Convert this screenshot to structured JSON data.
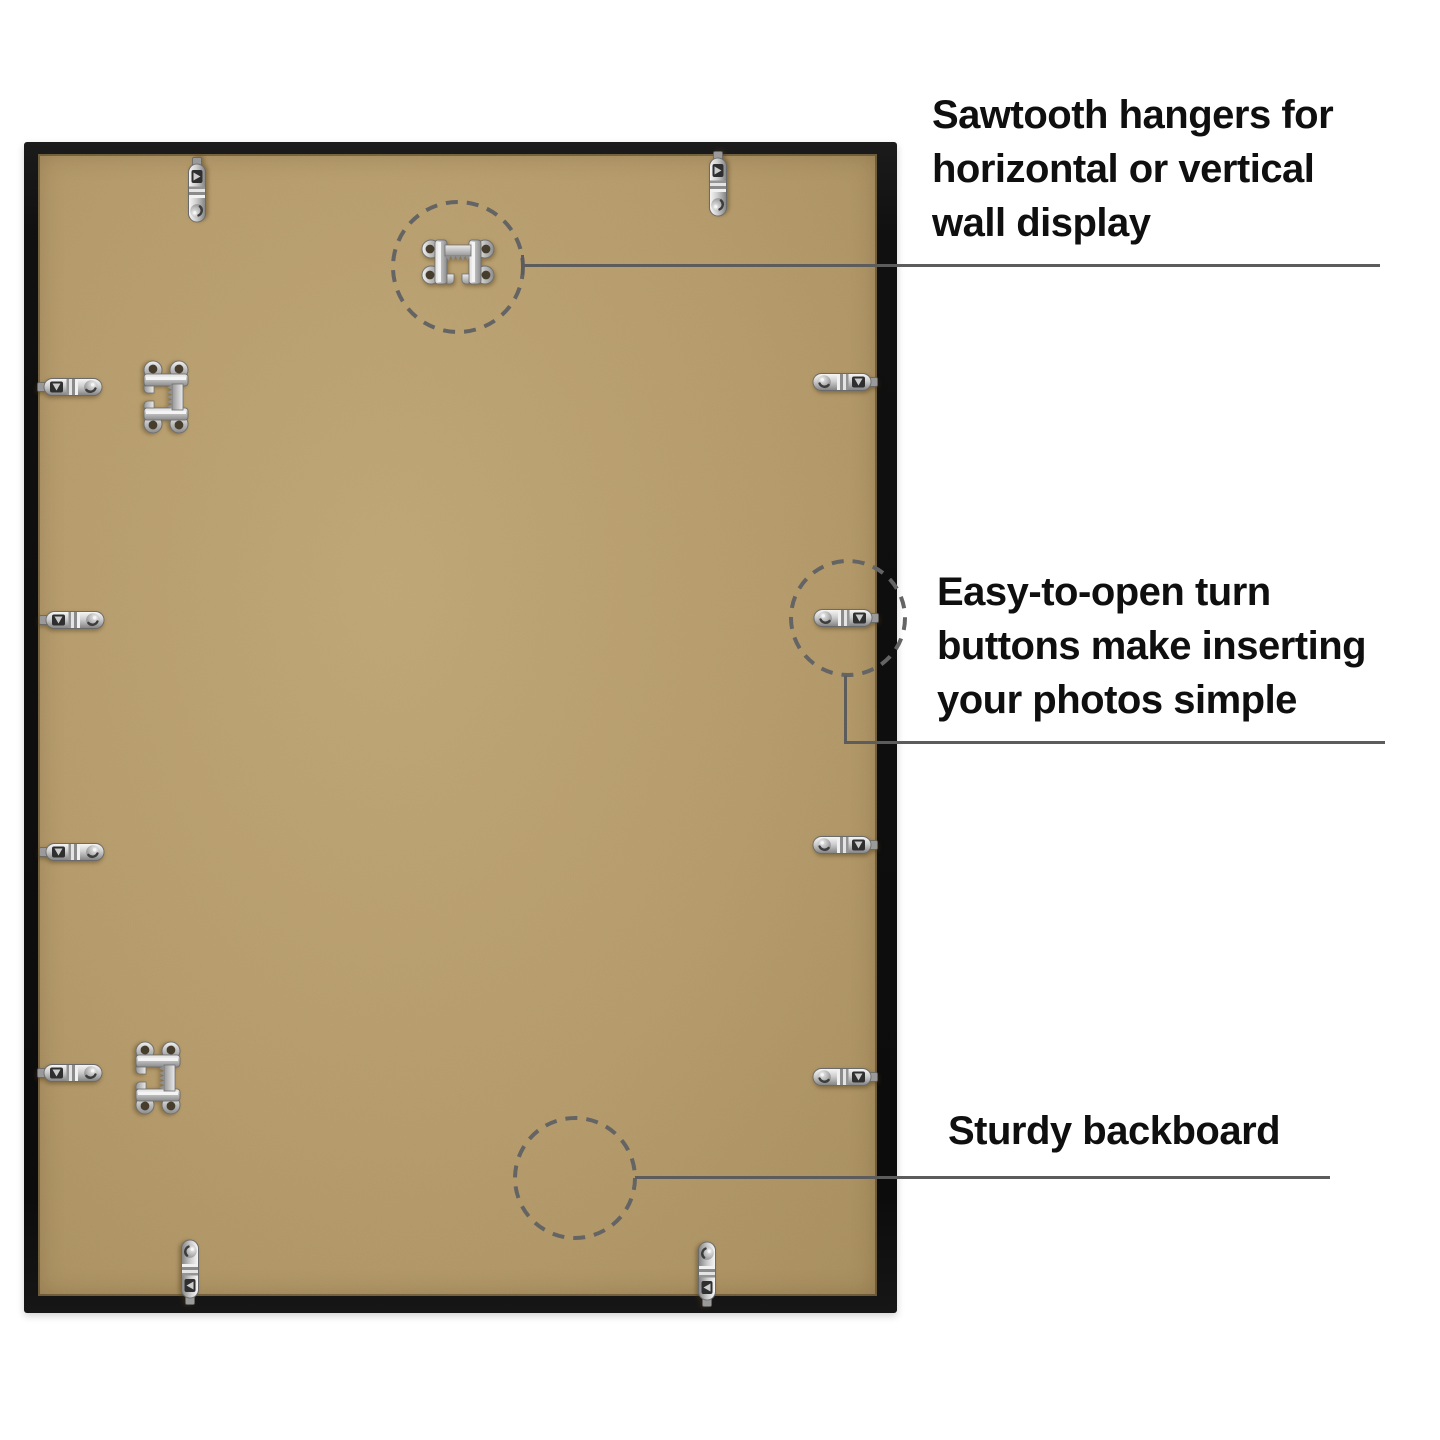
{
  "alt": "Back view of a black picture frame with tan backboard, metal sawtooth hangers and turn-button clips, annotated with three callouts",
  "annotations": [
    {
      "id": "sawtooth-hangers",
      "lines": [
        "Sawtooth hangers for",
        "horizontal or vertical",
        "wall display"
      ]
    },
    {
      "id": "turn-buttons",
      "lines": [
        "Easy-to-open turn",
        "buttons make inserting",
        "your photos simple"
      ]
    },
    {
      "id": "backboard",
      "lines": [
        "Sturdy backboard"
      ]
    }
  ],
  "hardware": {
    "sawtooth_hangers": {
      "label": "sawtooth hanger",
      "count": 3
    },
    "turn_buttons": {
      "label": "turn button",
      "count": 12
    }
  },
  "colors": {
    "background": "#ffffff",
    "frame": "#101010",
    "backboard": "#b49a6c",
    "metal": "#c9c9c9",
    "callout_line": "#5c5c5c",
    "callout_circle": "#646464",
    "text": "#0f0f0f"
  }
}
